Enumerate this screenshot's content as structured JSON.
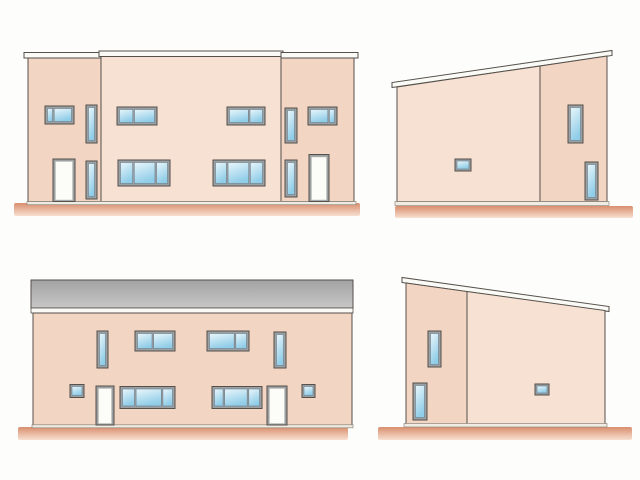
{
  "description": "Architectural elevation drawing sheet with four exterior views of a house; no visible text or labels",
  "visible_text": [],
  "colors": {
    "background": "#fdfdfc",
    "outline": "#55504a",
    "wall": "#f3d5c3",
    "wall_light": "#f7e1d3",
    "frame": "#9aa0a4",
    "pane_edge": "#707e88",
    "glass_top": "#e9f6fb",
    "glass_bottom": "#90cde8",
    "door": "#fcfcf8",
    "door_edge": "#c9c6be",
    "roof_white": "#fafaf6",
    "roof_gray_top": "#a2a2a2",
    "roof_gray_bottom": "#c7c7c7",
    "ground_top": "#d98e6d",
    "ground_bottom": "#f8e0d1",
    "base": "#f0ebe3",
    "base_edge": "#8d877d"
  },
  "elevations": [
    {
      "name": "front-elevation-two-story",
      "items": [
        {
          "name": "ground-strip",
          "x": 14,
          "y": 203,
          "w": 346,
          "h": 13,
          "fill": "url(#groundgrad)",
          "rx": 2
        },
        {
          "name": "roof-band-left",
          "x": 24,
          "y": 52.5,
          "w": 78,
          "h": 5.5,
          "fill": "roof_white",
          "stroke": "outline",
          "sw": 1
        },
        {
          "name": "roof-band-middle",
          "x": 99,
          "y": 51,
          "w": 184,
          "h": 5.5,
          "fill": "roof_white",
          "stroke": "outline",
          "sw": 1
        },
        {
          "name": "roof-band-right",
          "x": 281,
          "y": 52.5,
          "w": 77,
          "h": 5.5,
          "fill": "roof_white",
          "stroke": "outline",
          "sw": 1
        },
        {
          "name": "wall-left-unit",
          "x": 28,
          "y": 58,
          "w": 73,
          "h": 143.5,
          "fill": "wall",
          "stroke": "outline",
          "sw": 1
        },
        {
          "name": "wall-middle-unit",
          "x": 101,
          "y": 56.5,
          "w": 180,
          "h": 145,
          "fill": "wall_light",
          "stroke": "outline",
          "sw": 1
        },
        {
          "name": "wall-right-unit",
          "x": 281,
          "y": 58,
          "w": 73,
          "h": 143.5,
          "fill": "wall",
          "stroke": "outline",
          "sw": 1
        },
        {
          "name": "base-strip",
          "x": 27,
          "y": 201.5,
          "w": 329,
          "h": 3.2,
          "fill": "base",
          "stroke": "base_edge",
          "sw": 0.7
        },
        {
          "type": "window",
          "name": "window-upper-left",
          "x": 45,
          "y": 106,
          "w": 29,
          "h": 18,
          "panes": [
            1,
            3.4
          ]
        },
        {
          "type": "window",
          "name": "window-vertical",
          "x": 86,
          "y": 105,
          "w": 11,
          "h": 38,
          "panes": [
            1
          ]
        },
        {
          "type": "window",
          "name": "window-upper",
          "x": 117,
          "y": 107,
          "w": 40,
          "h": 18,
          "panes": [
            1,
            1.5
          ]
        },
        {
          "type": "window",
          "name": "window-upper",
          "x": 227,
          "y": 107,
          "w": 38,
          "h": 18,
          "panes": [
            1.5,
            1
          ]
        },
        {
          "type": "window",
          "name": "window-vertical",
          "x": 285,
          "y": 108,
          "w": 12,
          "h": 35,
          "panes": [
            1
          ]
        },
        {
          "type": "window",
          "name": "window-upper-right",
          "x": 308,
          "y": 107,
          "w": 29,
          "h": 18,
          "panes": [
            3.4,
            1
          ]
        },
        {
          "type": "door",
          "name": "entry-door",
          "x": 53,
          "y": 159,
          "w": 22,
          "h": 42.5
        },
        {
          "type": "window",
          "name": "window-vertical",
          "x": 86,
          "y": 161,
          "w": 11,
          "h": 38,
          "panes": [
            1
          ]
        },
        {
          "type": "window",
          "name": "window-lower",
          "x": 118,
          "y": 160,
          "w": 52,
          "h": 26,
          "panes": [
            1,
            1.7,
            0.9
          ]
        },
        {
          "type": "window",
          "name": "window-lower",
          "x": 213,
          "y": 160,
          "w": 52,
          "h": 26,
          "panes": [
            0.9,
            1.7,
            1
          ]
        },
        {
          "type": "window",
          "name": "window-vertical",
          "x": 285,
          "y": 160,
          "w": 12,
          "h": 37,
          "panes": [
            1
          ]
        },
        {
          "type": "door",
          "name": "entry-door",
          "x": 309,
          "y": 154.5,
          "w": 20,
          "h": 47
        }
      ]
    },
    {
      "name": "right-side-elevation-monopitch",
      "items": [
        {
          "name": "ground-strip",
          "x": 395,
          "y": 206,
          "w": 238,
          "h": 12,
          "fill": "url(#groundgrad)",
          "rx": 2
        },
        {
          "name": "roof-band-sloped",
          "points": "392,87.5 612,55.5 612,50.5 392,82.5",
          "fill": "roof_white",
          "stroke": "outline",
          "sw": 1
        },
        {
          "name": "wall-main",
          "points": "397,87 540,66 540,201.5 397,201.5",
          "fill": "wall_light",
          "stroke": "outline",
          "sw": 1
        },
        {
          "name": "wall-end",
          "points": "540,66 607,56 607,201.5 540,201.5",
          "fill": "wall",
          "stroke": "outline",
          "sw": 1
        },
        {
          "name": "base-strip",
          "x": 395,
          "y": 201.5,
          "w": 214,
          "h": 4,
          "fill": "base",
          "stroke": "base_edge",
          "sw": 0.7
        },
        {
          "type": "window",
          "name": "window-small",
          "x": 455,
          "y": 159,
          "w": 16,
          "h": 12,
          "panes": [
            1
          ],
          "f": 2
        },
        {
          "type": "window",
          "name": "window-vertical",
          "x": 568,
          "y": 105,
          "w": 15,
          "h": 38,
          "panes": [
            1
          ]
        },
        {
          "type": "window",
          "name": "window-vertical",
          "x": 585,
          "y": 162,
          "w": 13,
          "h": 38,
          "panes": [
            1
          ]
        }
      ]
    },
    {
      "name": "rear-elevation-two-story",
      "items": [
        {
          "name": "ground-strip",
          "x": 18,
          "y": 427,
          "w": 330,
          "h": 13,
          "fill": "url(#groundgrad)",
          "rx": 2
        },
        {
          "name": "roof-slope-gray",
          "x": 31,
          "y": 280,
          "w": 322,
          "h": 28,
          "fill": "url(#roofgrad)",
          "stroke": "outline",
          "sw": 1
        },
        {
          "name": "roof-fascia",
          "x": 31,
          "y": 308,
          "w": 322,
          "h": 5,
          "fill": "roof_white",
          "stroke": "outline",
          "sw": 0.8
        },
        {
          "name": "wall-main",
          "x": 33,
          "y": 313,
          "w": 319,
          "h": 112,
          "fill": "wall",
          "stroke": "outline",
          "sw": 1
        },
        {
          "name": "base-strip",
          "x": 32,
          "y": 424.8,
          "w": 321,
          "h": 3,
          "fill": "base",
          "stroke": "base_edge",
          "sw": 0.7
        },
        {
          "type": "window",
          "name": "window-vertical",
          "x": 97,
          "y": 331,
          "w": 11,
          "h": 37,
          "panes": [
            1
          ]
        },
        {
          "type": "window",
          "name": "window-upper",
          "x": 135,
          "y": 331,
          "w": 40,
          "h": 20,
          "panes": [
            1,
            1.3
          ]
        },
        {
          "type": "window",
          "name": "window-upper",
          "x": 207,
          "y": 331,
          "w": 42,
          "h": 20,
          "panes": [
            2.3,
            1
          ]
        },
        {
          "type": "window",
          "name": "window-vertical",
          "x": 274,
          "y": 332,
          "w": 12,
          "h": 36,
          "panes": [
            1
          ]
        },
        {
          "type": "window",
          "name": "window-small",
          "x": 70,
          "y": 384.5,
          "w": 14,
          "h": 13,
          "panes": [
            1
          ],
          "f": 2
        },
        {
          "type": "door",
          "name": "entry-door",
          "x": 96,
          "y": 386,
          "w": 18,
          "h": 39
        },
        {
          "type": "window",
          "name": "window-lower",
          "x": 120,
          "y": 386.5,
          "w": 55,
          "h": 22,
          "panes": [
            1,
            2.1,
            0.8
          ]
        },
        {
          "type": "window",
          "name": "window-lower",
          "x": 212,
          "y": 386.5,
          "w": 50,
          "h": 22,
          "panes": [
            0.8,
            2.1,
            1
          ]
        },
        {
          "type": "door",
          "name": "entry-door",
          "x": 267,
          "y": 386,
          "w": 20,
          "h": 39
        },
        {
          "type": "window",
          "name": "window-small",
          "x": 302,
          "y": 384.5,
          "w": 13,
          "h": 13,
          "panes": [
            1
          ],
          "f": 2
        }
      ]
    },
    {
      "name": "left-side-elevation-monopitch",
      "items": [
        {
          "name": "ground-strip",
          "x": 378,
          "y": 427,
          "w": 254,
          "h": 13,
          "fill": "url(#groundgrad)",
          "rx": 2
        },
        {
          "name": "roof-band-sloped",
          "points": "402,282.5 609,311.5 609,306.5 402,277.5",
          "fill": "roof_white",
          "stroke": "outline",
          "sw": 1
        },
        {
          "name": "wall-end",
          "points": "406,283 467,291.5 467,424 406,424",
          "fill": "wall",
          "stroke": "outline",
          "sw": 1
        },
        {
          "name": "wall-main",
          "points": "467,291.5 605,310.5 605,424 467,424",
          "fill": "wall_light",
          "stroke": "outline",
          "sw": 1
        },
        {
          "name": "base-strip",
          "x": 404,
          "y": 423.5,
          "w": 203,
          "h": 3.5,
          "fill": "base",
          "stroke": "base_edge",
          "sw": 0.7
        },
        {
          "type": "window",
          "name": "window-vertical",
          "x": 428,
          "y": 331,
          "w": 13,
          "h": 36,
          "panes": [
            1
          ]
        },
        {
          "type": "window",
          "name": "window-vertical",
          "x": 413,
          "y": 383,
          "w": 14,
          "h": 37,
          "panes": [
            1
          ]
        },
        {
          "type": "window",
          "name": "window-small",
          "x": 535,
          "y": 384,
          "w": 14,
          "h": 11,
          "panes": [
            1
          ],
          "f": 2
        }
      ]
    }
  ]
}
